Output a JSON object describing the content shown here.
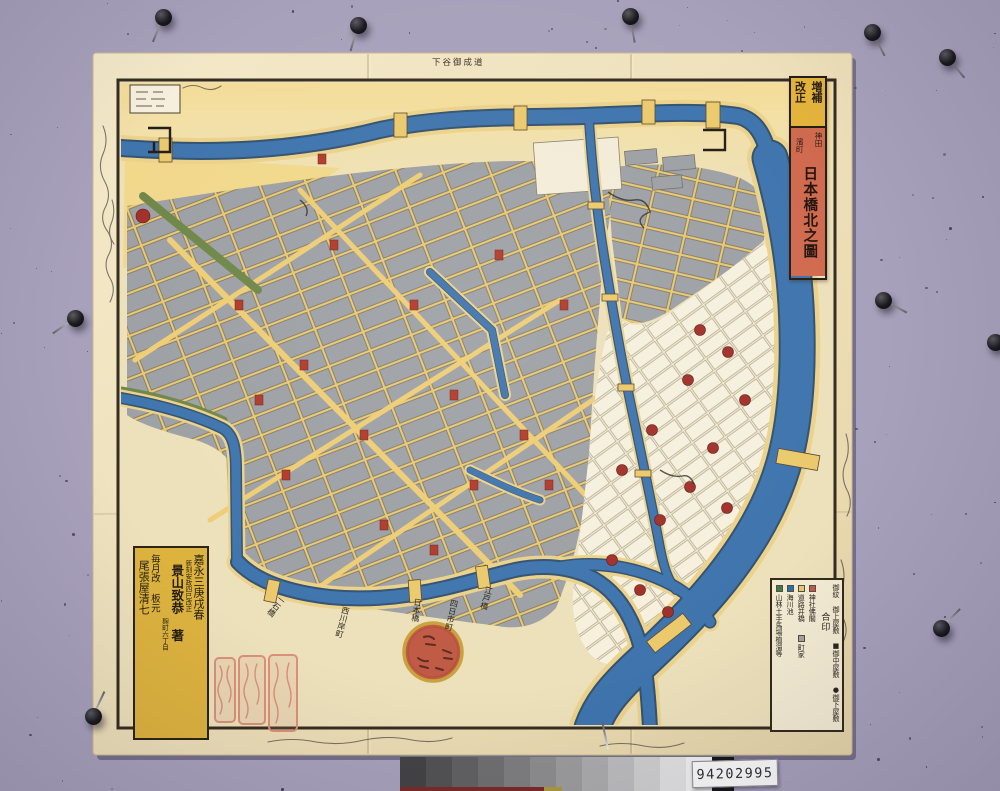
{
  "photo": {
    "board_color": "#a7a1bb",
    "barcode_label": "94202995",
    "grayscale_steps": [
      "#434345",
      "#525254",
      "#616163",
      "#6f6f71",
      "#7e7e80",
      "#8d8d8f",
      "#9c9c9e",
      "#ababad",
      "#bcbcbe",
      "#cecece",
      "#e0e0e0",
      "#efefef"
    ]
  },
  "map": {
    "cartouche": {
      "edition_top": "増補",
      "edition_bottom": "改正",
      "area_right": "神田",
      "area_left": "濱町",
      "title": "日本橋北之圖"
    },
    "margin_note_top": "下谷御成道",
    "legend": {
      "header": "合印",
      "estates_line": "御紋 御上屋敷 ■御中屋敷 ●御下屋敷",
      "items": [
        {
          "label": "神社佛閣",
          "color": "#c4574a"
        },
        {
          "label": "道路并橋",
          "color": "#e8c86c"
        },
        {
          "label": "町家",
          "color": "#a2a2a4"
        },
        {
          "label": "海川池",
          "color": "#2f6fae"
        },
        {
          "label": "山林土手馬場植溜等",
          "color": "#3e7a52"
        }
      ]
    },
    "colophon": {
      "date_line": "嘉永三庚戌春",
      "revision_line": "新刻安政四巳改正",
      "author": "景山致恭 著",
      "address_line": "麹町六丁目",
      "publisher_line": "毎月改 板元",
      "publisher": "尾張屋清七"
    },
    "place_labels": [
      {
        "text": "一石橋"
      },
      {
        "text": "西川岸町"
      },
      {
        "text": "日本橋"
      },
      {
        "text": "四日市町"
      },
      {
        "text": "江戸橋"
      }
    ]
  }
}
